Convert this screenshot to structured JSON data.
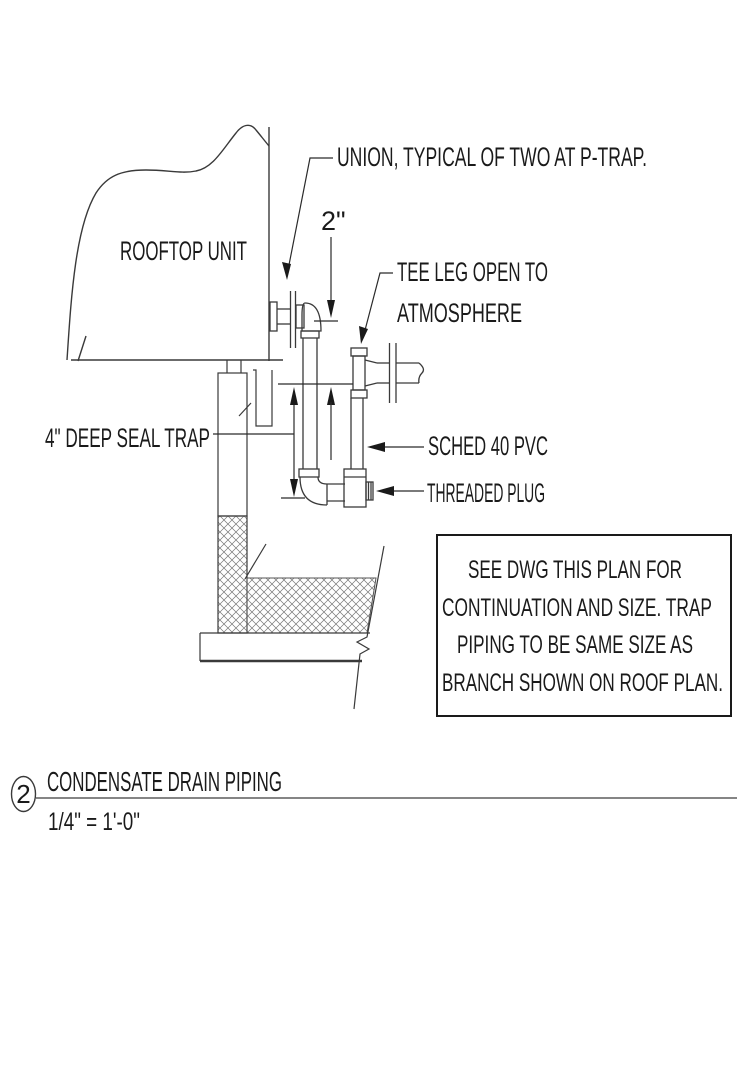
{
  "drawing": {
    "callouts": {
      "union": "UNION, TYPICAL OF TWO AT P-TRAP.",
      "dim_2in": "2\"",
      "tee_leg_line1": "TEE LEG OPEN TO",
      "tee_leg_line2": "ATMOSPHERE",
      "rooftop_unit": "ROOFTOP UNIT",
      "deep_seal_trap": "4\" DEEP SEAL TRAP",
      "sched_40_pvc": "SCHED 40 PVC",
      "threaded_plug": "THREADED PLUG"
    },
    "note_box": {
      "lines": [
        "SEE DWG THIS PLAN FOR",
        "CONTINUATION AND SIZE. TRAP",
        "PIPING TO BE SAME SIZE AS",
        "BRANCH SHOWN ON ROOF PLAN."
      ]
    },
    "title_block": {
      "detail_number": "2",
      "title": "CONDENSATE DRAIN PIPING",
      "scale": "1/4\" = 1'-0\""
    },
    "colors": {
      "line": "#3a3a3a",
      "text": "#1a1a1a",
      "hatch": "#777777",
      "title_rule": "#858585",
      "background": "#ffffff"
    }
  }
}
